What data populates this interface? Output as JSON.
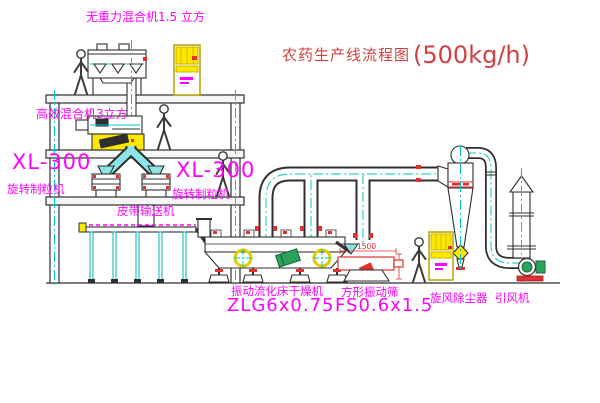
{
  "title": {
    "name": "农药生产线流程图",
    "capacity": "(500kg/h)"
  },
  "labels": {
    "top_mixer": "无重力混合机1.5 立方",
    "mid_mixer": "高效混合机3立方",
    "left_granulator_model": "XL-300",
    "left_granulator_name": "旋转制粒机",
    "mid_granulator_model": "XL-300",
    "mid_granulator_name": "旋转制粒机",
    "belt_conveyor": "皮带输送机",
    "dryer_name": "振动流化床干燥机",
    "dryer_model": "ZLG6x0.75",
    "screen_name": "方形振动筛",
    "screen_model": "FS0.6x1.5",
    "cyclone": "旋风除尘器",
    "induced_draft_fan": "引风机"
  },
  "dimensions": {
    "screen_length": "1500"
  },
  "colors": {
    "line": "#2f2f2f",
    "cyan": "#00c8c8",
    "magenta": "#ff00ff",
    "red": "#e03030",
    "title_red": "#d34040",
    "yellow": "#ffe800",
    "green": "#2aa45c"
  }
}
